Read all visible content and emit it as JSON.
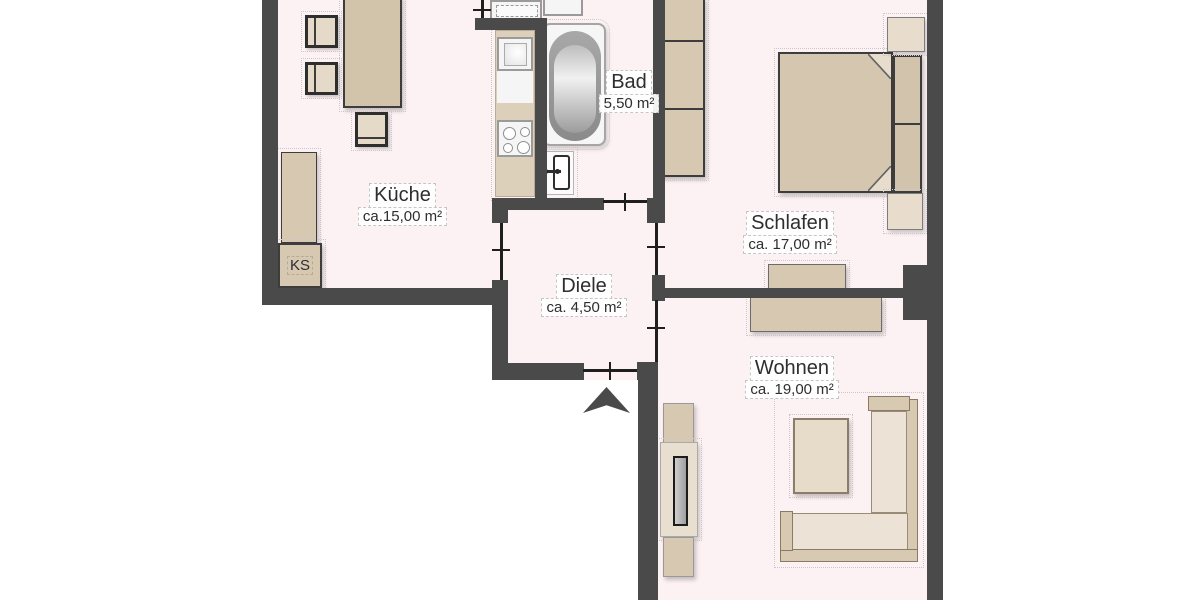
{
  "plan": {
    "type": "apartment-floor-plan",
    "rooms": [
      {
        "id": "kueche",
        "name": "Küche",
        "area": "ca.15,00 m²"
      },
      {
        "id": "bad",
        "name": "Bad",
        "area": "5,50 m²"
      },
      {
        "id": "diele",
        "name": "Diele",
        "area": "ca. 4,50 m²"
      },
      {
        "id": "schlafen",
        "name": "Schlafen",
        "area": "ca. 17,00 m²"
      },
      {
        "id": "wohnen",
        "name": "Wohnen",
        "area": "ca. 19,00 m²"
      }
    ],
    "labels": {
      "fridge": "KS"
    },
    "colors": {
      "floor": "#fcf1f3",
      "wall": "#4a4a4a",
      "furniture": "#d7c8b2",
      "furniture_light": "#e8ddcd",
      "fixture_white": "#f5f5f5",
      "outline_dark": "#3d3d3d",
      "background": "#ffffff"
    }
  }
}
